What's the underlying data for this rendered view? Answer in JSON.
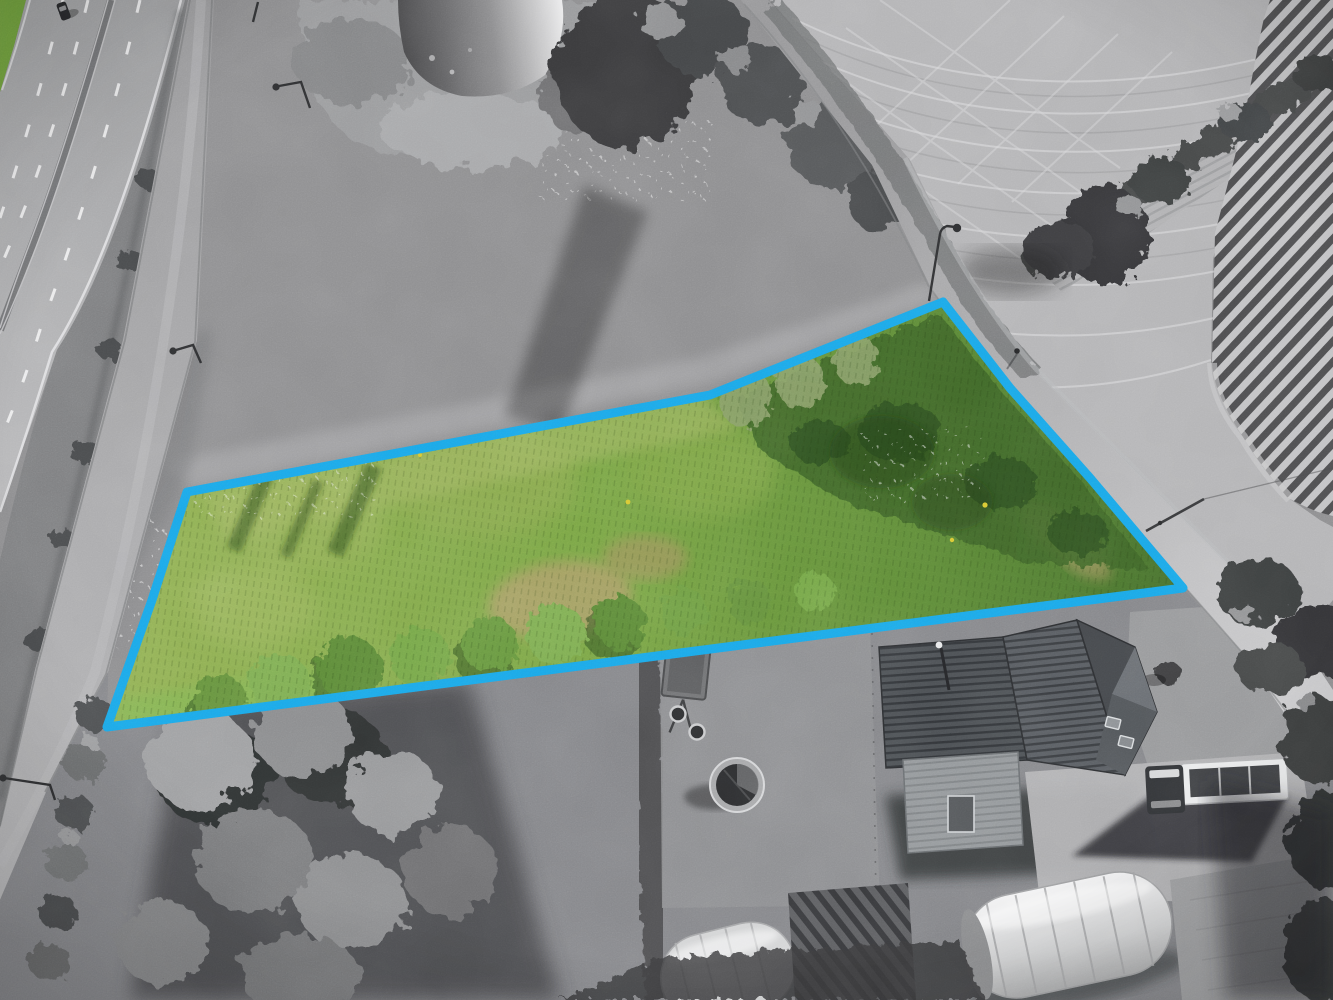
{
  "scene": {
    "kind": "aerial-drone-photograph",
    "style": "color-pop-on-grayscale",
    "subject": "building-plot-outlined-in-blue",
    "palette": {
      "accent_blue": "#1ba7e8",
      "parcel_green_light": "#93b158",
      "parcel_green_mid": "#74a143",
      "parcel_green_dark": "#3c6128",
      "parcel_dry_grass": "#ab9e66",
      "flower_yellow": "#d8c832",
      "grayscale_field_pale": "#b4b4b6",
      "grayscale_meadow": "#8d8d8f",
      "asphalt": "#a9a9ab",
      "tree_dark": "#3f4042",
      "roof_dark": "#4b4f54",
      "greenhouse_white": "#e9eaeb",
      "water_dark": "#4a4a4c",
      "water_glare": "#ebebec",
      "shadow": "#232426"
    }
  },
  "parcel": {
    "outline_points": "187,492 710,395 943,302 1010,388 1090,478 1183,588 107,727 152,600",
    "outline_stroke_width": "9",
    "fill_style": "natural-green-meadow-with-shrubs"
  },
  "features": [
    {
      "name": "motorway",
      "desc": "dual carriageway with white lane dashes and median barrier, upper left, grayscale"
    },
    {
      "name": "car-on-motorway",
      "desc": "single dark car, top left"
    },
    {
      "name": "green-verge-corner",
      "desc": "small colored grass strip in extreme top-left corner"
    },
    {
      "name": "service-road",
      "desc": "narrow parallel road between motorway and meadow"
    },
    {
      "name": "roadside-ditch",
      "desc": "scrub strip separating motorway and service road"
    },
    {
      "name": "street-lights",
      "desc": "several lamp posts along roads"
    },
    {
      "name": "pond",
      "desc": "small pond with bright sun glare, top centre"
    },
    {
      "name": "reed-bank",
      "desc": "pale reeds around pond"
    },
    {
      "name": "tree-group-long-shadow",
      "desc": "dark trees north of parcel casting shadow"
    },
    {
      "name": "rough-meadow",
      "desc": "grayscale tall-grass meadow surrounding parcel"
    },
    {
      "name": "highlighted-parcel",
      "desc": "only colored area: green meadow with shrub rows, dry patch, blue boundary"
    },
    {
      "name": "willow-shrub-row",
      "desc": "green tree crowns along parcel south edge"
    },
    {
      "name": "dry-grass-patch",
      "desc": "tan patches inside parcel"
    },
    {
      "name": "country-lane",
      "desc": "light lane along parcel east side"
    },
    {
      "name": "pedestrian",
      "desc": "tiny walker on lane beside parcel"
    },
    {
      "name": "utility-pole",
      "desc": "pole with shadow across lane"
    },
    {
      "name": "harvested-field-tramlines",
      "desc": "pale field with curved machine tracks, top right"
    },
    {
      "name": "hedgerow-trees",
      "desc": "dark hedge row crossing fields diagonally"
    },
    {
      "name": "ridged-crop-field",
      "desc": "bold dark/light diagonal bed stripes, right edge"
    },
    {
      "name": "farmhouse",
      "desc": "large house with ribbed dark roof, bottom right"
    },
    {
      "name": "barn-outbuilding",
      "desc": "small ribbed-roof barn with door"
    },
    {
      "name": "flatbed-truck",
      "desc": "white truck with dark cab and open bed, parked on gravel"
    },
    {
      "name": "gravel-yard",
      "desc": "light parking area near truck"
    },
    {
      "name": "garden-hot-tub",
      "desc": "round tub on lawn"
    },
    {
      "name": "garden-trailer",
      "desc": "small cart with two wheels"
    },
    {
      "name": "polytunnel-greenhouses",
      "desc": "two white arched tunnels at bottom"
    },
    {
      "name": "vegetable-rows",
      "desc": "dark crop rows between tunnels"
    },
    {
      "name": "tree-canopies-south",
      "desc": "large gray canopies below parcel"
    }
  ]
}
